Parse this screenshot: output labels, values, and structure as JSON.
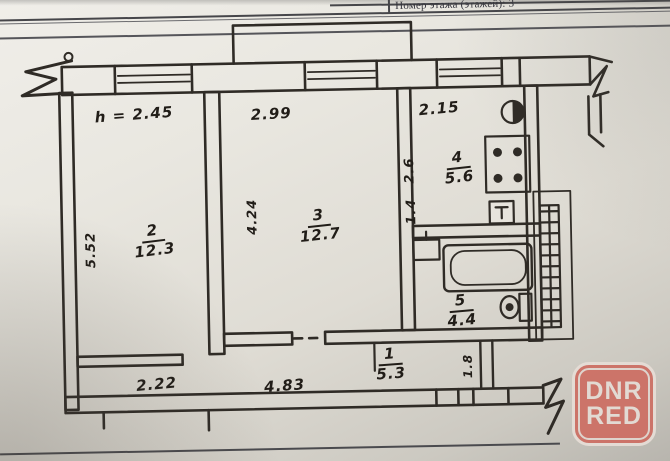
{
  "document": {
    "header_label": "Номер этажа (этажей): 3"
  },
  "plan": {
    "ceiling_height": "h = 2.45",
    "rooms": [
      {
        "key": "living-room-2",
        "number": "2",
        "area": "12.3"
      },
      {
        "key": "living-room-3",
        "number": "3",
        "area": "12.7"
      },
      {
        "key": "kitchen-4",
        "number": "4",
        "area": "5.6"
      },
      {
        "key": "bathroom-5",
        "number": "5",
        "area": "4.4"
      },
      {
        "key": "corridor-1",
        "number": "1",
        "area": "5.3"
      }
    ],
    "dimensions": {
      "room2_depth": "5.52",
      "room2_width": "2.22",
      "room3_width": "2.99",
      "room3_depth": "4.24",
      "kitchen_width": "2.15",
      "kitchen_depth": "2.6",
      "niche_depth": "1.4",
      "corridor_length": "4.83",
      "entry_width": "1.8"
    }
  },
  "watermark": {
    "line1": "DNR",
    "line2": "RED"
  }
}
